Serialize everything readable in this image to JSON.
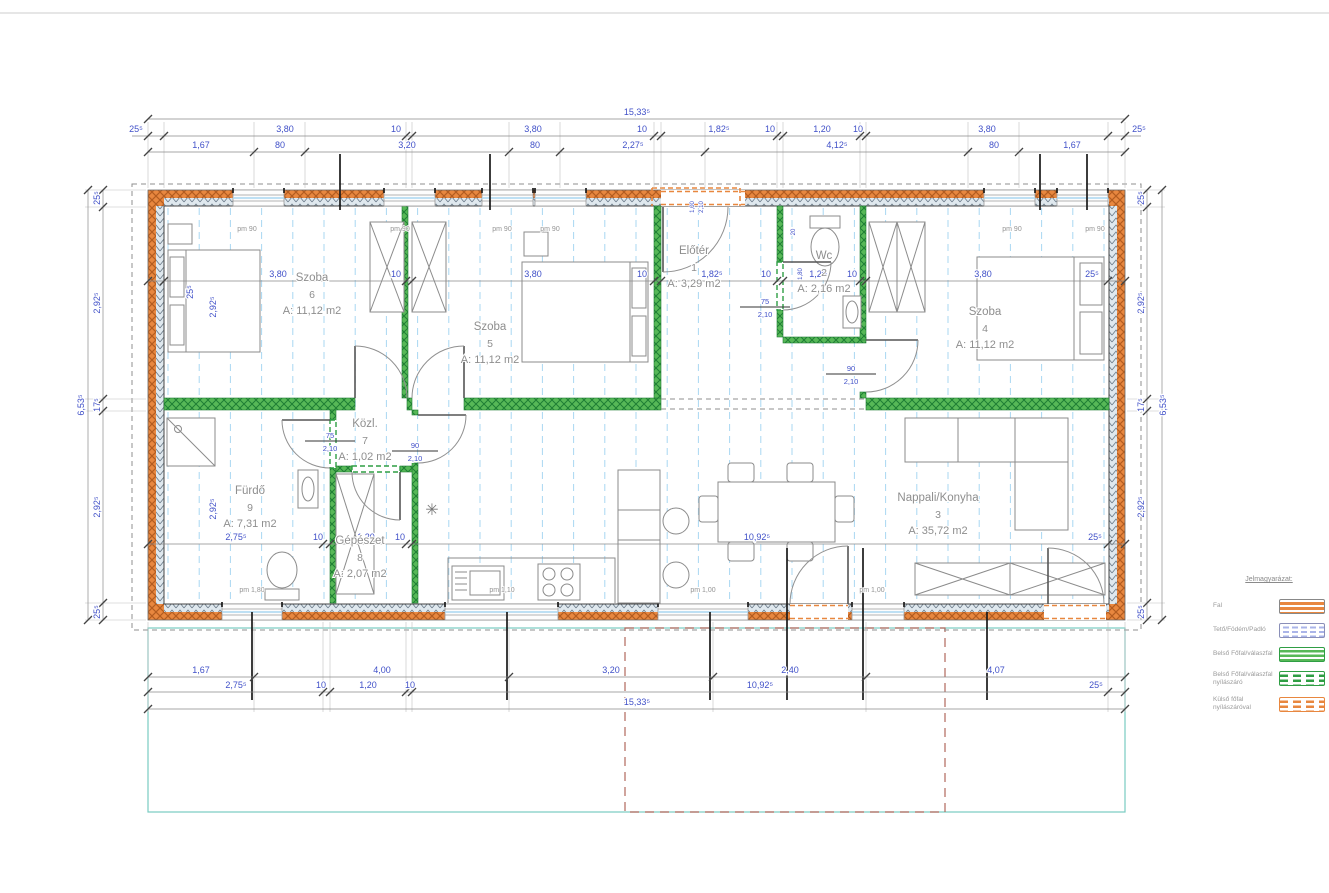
{
  "dims": {
    "overall_width": "15,33⁵",
    "overall_height": "6,53⁵",
    "top_row2": [
      "25⁵",
      "3,80",
      "10",
      "3,80",
      "10",
      "1,82⁵",
      "10",
      "1,20",
      "10",
      "3,80",
      "25⁵"
    ],
    "top_row3": [
      "1,67",
      "80",
      "3,20",
      "80",
      "2,27⁵",
      "4,12⁵",
      "80",
      "1,67"
    ],
    "bottom_row1": [
      "1,67",
      "4,00",
      "3,20",
      "2,40",
      "4,07"
    ],
    "bottom_row2": [
      "2,75⁵",
      "10",
      "1,20",
      "10",
      "10,92⁵",
      "25⁵"
    ],
    "side_left": [
      "25⁵",
      "2,92⁵",
      "17⁵",
      "2,92⁵",
      "25⁵"
    ],
    "side_right": [
      "25⁵",
      "2,92⁵",
      "17⁵",
      "2,92⁵",
      "25⁵"
    ],
    "interior_top": [
      "25⁵",
      "3,80",
      "10",
      "3,80",
      "10",
      "1,82⁵",
      "10",
      "1,20",
      "10",
      "3,80",
      "25⁵"
    ],
    "interior_bottom": [
      "2,75⁵",
      "10",
      "1,20",
      "10",
      "10,92⁵",
      "25⁵"
    ],
    "inner_left_upper": "2,92⁵",
    "inner_left_lower": "2,92⁵",
    "entry_door": [
      "1,00",
      "2,10"
    ],
    "wc_dims": [
      "20",
      "1,80"
    ]
  },
  "rooms": [
    {
      "name": "Szoba",
      "number": "6",
      "area": "A: 11,12 m2"
    },
    {
      "name": "Szoba",
      "number": "5",
      "area": "A: 11,12 m2"
    },
    {
      "name": "Előtér",
      "number": "1",
      "area": "A: 3,29 m2"
    },
    {
      "name": "Wc",
      "number": "2",
      "area": "A: 2,16 m2"
    },
    {
      "name": "Szoba",
      "number": "4",
      "area": "A: 11,12 m2"
    },
    {
      "name": "Fürdő",
      "number": "9",
      "area": "A: 7,31 m2"
    },
    {
      "name": "Közl.",
      "number": "7",
      "area": "A: 1,02 m2"
    },
    {
      "name": "Gépészet",
      "number": "8",
      "area": "A: 2,07 m2"
    },
    {
      "name": "Nappali/Konyha",
      "number": "3",
      "area": "A: 35,72 m2"
    }
  ],
  "door_sizes": [
    {
      "width": "75",
      "height": "2,10"
    },
    {
      "width": "90",
      "height": "2,10"
    },
    {
      "width": "75",
      "height": "2,10"
    },
    {
      "width": "90",
      "height": "2,10"
    }
  ],
  "window_labels": {
    "top": [
      "pm 90",
      "pm 90",
      "pm 90",
      "pm 90",
      "pm 90",
      "pm 90"
    ],
    "bottom": [
      "pm 1,80",
      "pm 1,10",
      "pm 1,00",
      "pm 1,00"
    ]
  },
  "symbols": {
    "vent": "✳"
  },
  "legend": {
    "title": "Jelmagyarázat:",
    "items": [
      {
        "label": "Fal"
      },
      {
        "label": "Tető/Födém/Padló"
      },
      {
        "label": "Belső Főfal/válaszfal"
      },
      {
        "label": "Belső Főfal/válaszfal nyílászáró"
      },
      {
        "label": "Külső főfal nyílászáróval"
      }
    ]
  },
  "colors": {
    "dimension_text": "#4050c8",
    "wall_exterior": "#e8873f",
    "wall_interior": "#2f9e44",
    "grid": "#a9d7f2",
    "room_text": "#8e8e8e",
    "overhang_dash": "#b0685c",
    "slab_teal": "#79ccc2"
  }
}
